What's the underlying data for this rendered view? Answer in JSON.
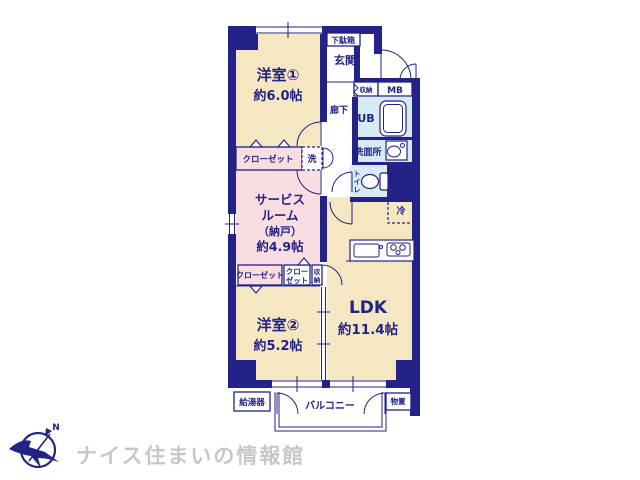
{
  "colors": {
    "navy": "#232287",
    "cream": "#f6e7c3",
    "pink": "#fadde1",
    "aqua": "#d7eaf6",
    "gray": "#c7c7cb"
  },
  "plan": {
    "rooms": {
      "yoshitsu1_name": "洋室①",
      "yoshitsu1_size": "約6.0帖",
      "service_l1": "サービス",
      "service_l2": "ルーム",
      "service_l3": "（納戸）",
      "service_l4": "約4.9帖",
      "yoshitsu2_name": "洋室②",
      "yoshitsu2_size": "約5.2帖",
      "ldk_name": "LDK",
      "ldk_size": "約11.4帖",
      "genkan": "玄関",
      "rouka": "廊下",
      "ub": "UB",
      "senmenjo": "洗面所",
      "toilet_c1": "ト",
      "toilet_c2": "イ",
      "toilet_c3": "レ",
      "balcony": "バルコニー"
    },
    "labels": {
      "getabako": "下駄箱",
      "shuno_hall": "収納",
      "mb": "MB",
      "rei": "冷",
      "sen": "洗",
      "closet1": "クローゼット",
      "closet2": "クローゼット",
      "closet3_l1": "クロー",
      "closet3_l2": "ゼット",
      "shuno2_c1": "収",
      "shuno2_c2": "納",
      "kyutoki": "給湯器",
      "monooki": "物置"
    },
    "compass": {
      "north": "N"
    },
    "footer": {
      "brand": "ナイス住まいの情報館"
    }
  }
}
